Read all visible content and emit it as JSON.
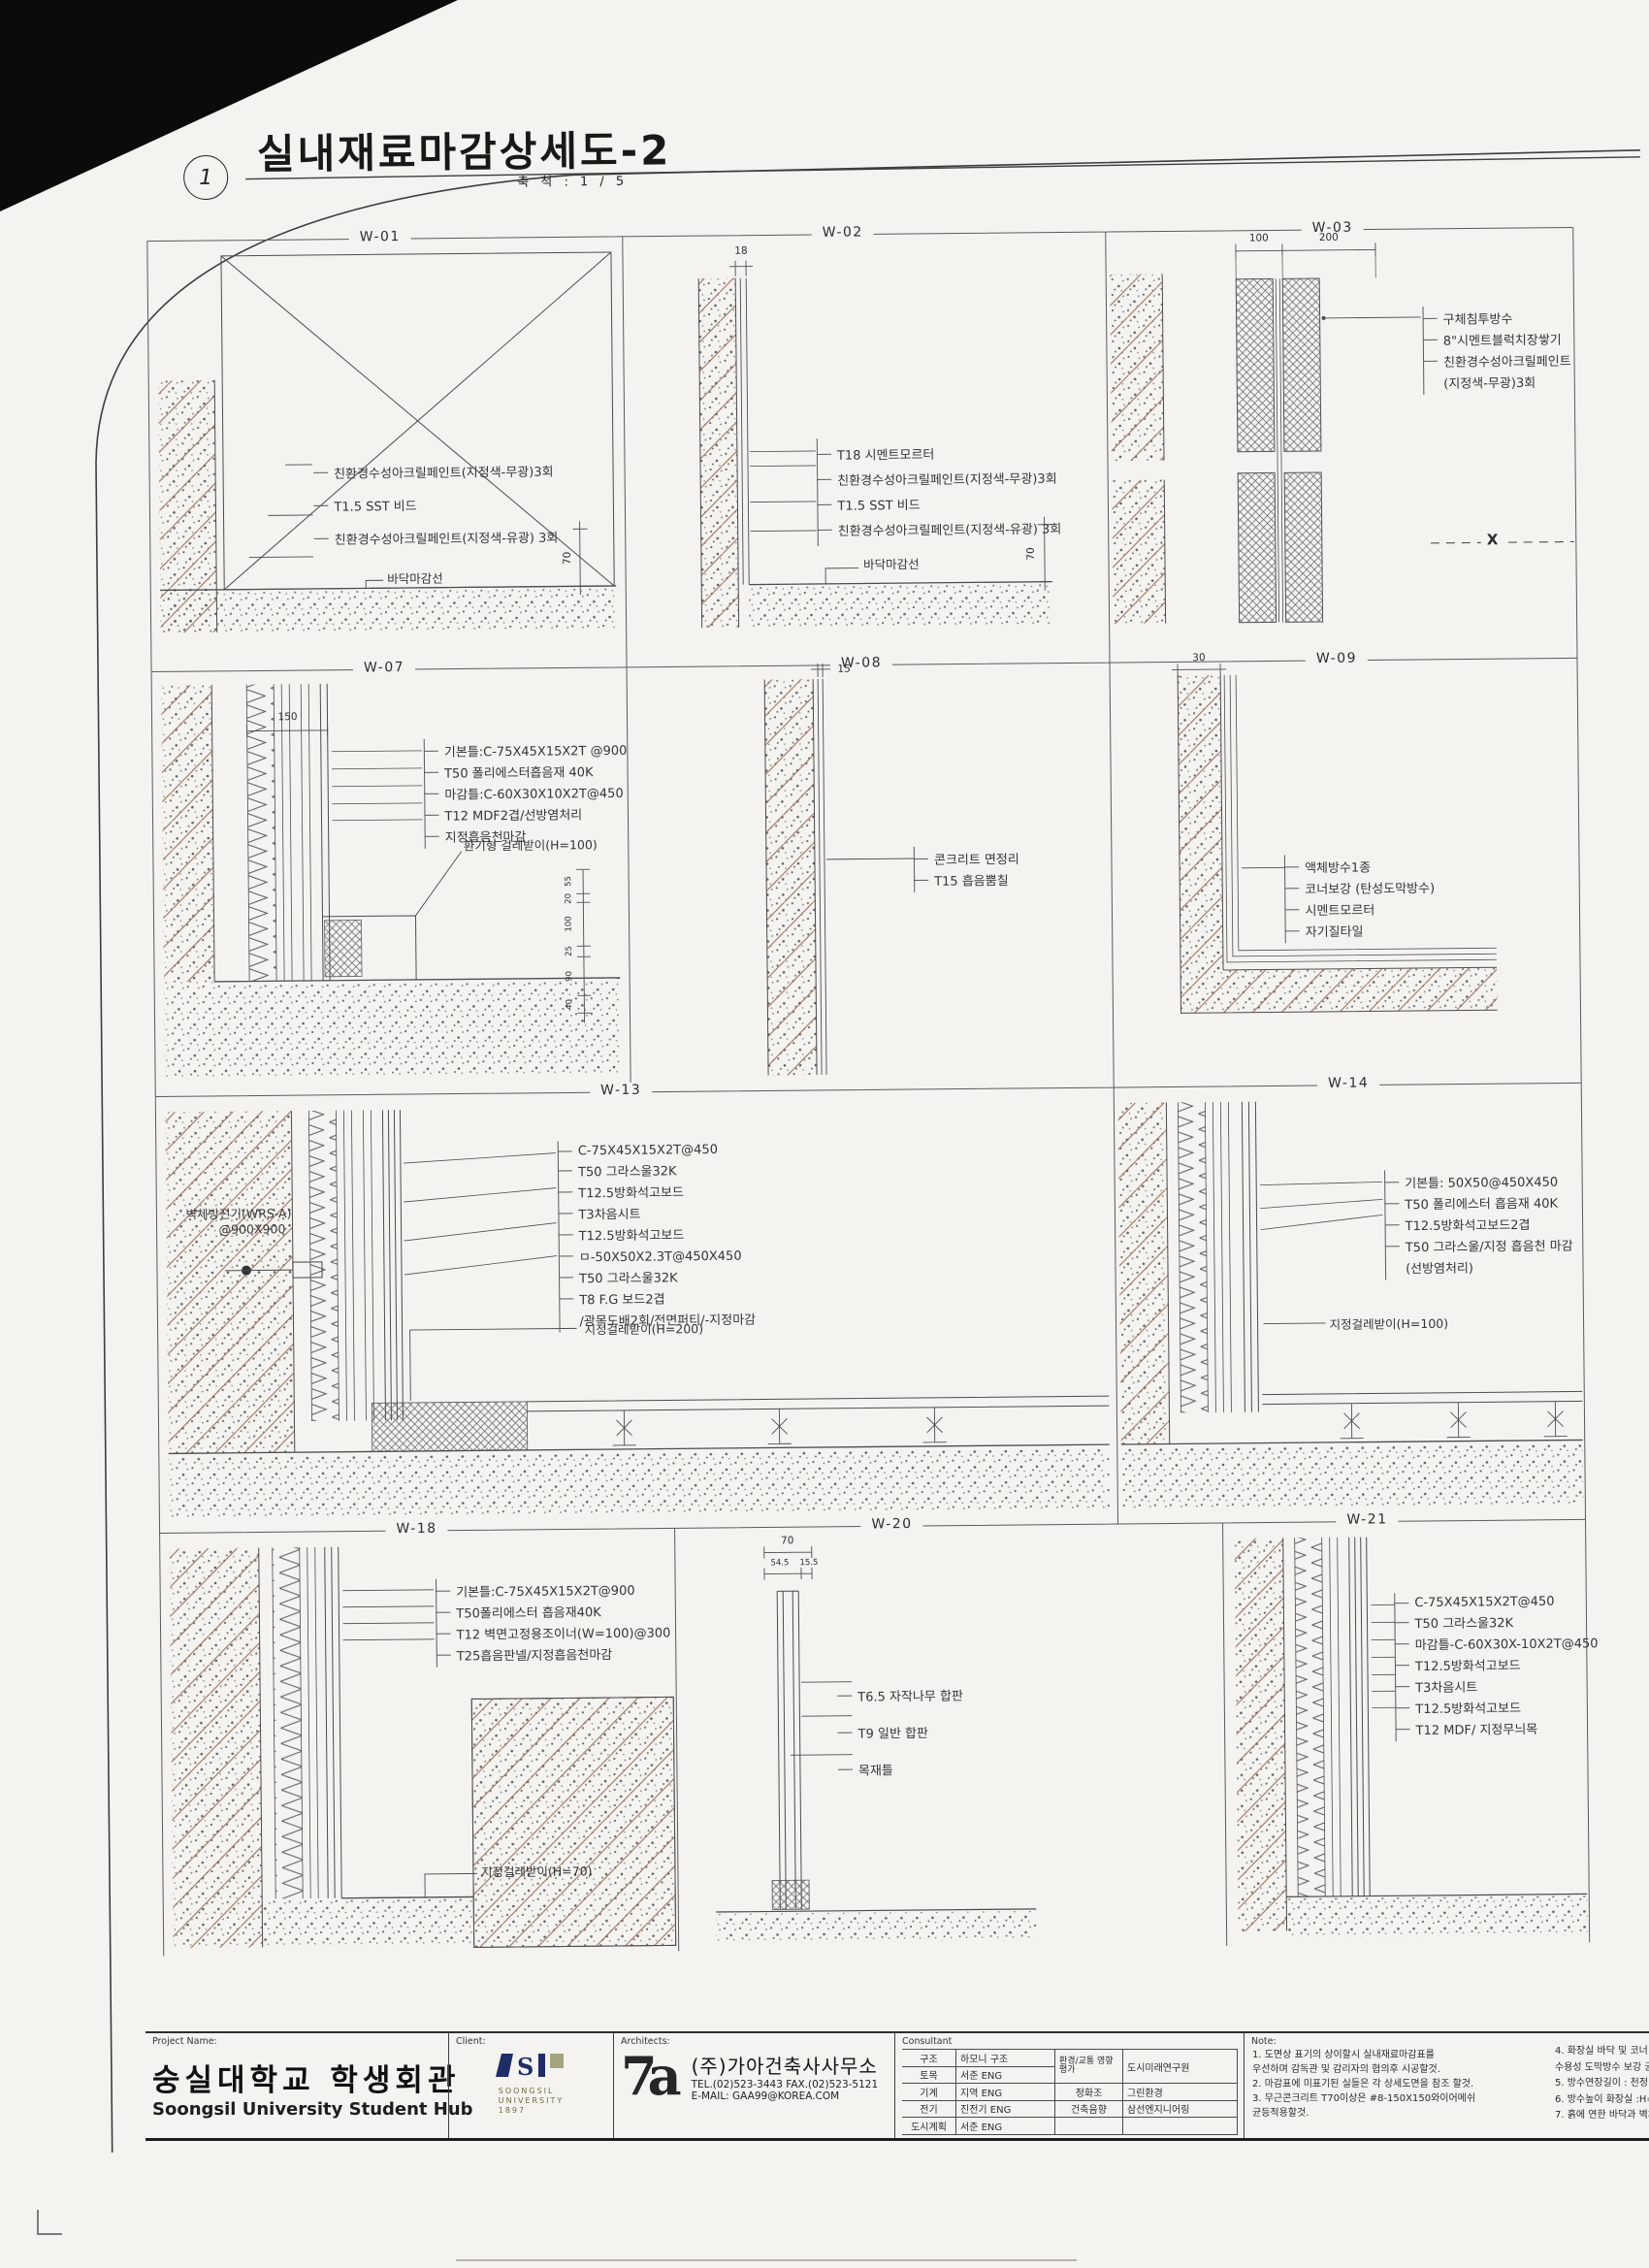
{
  "sheet": {
    "drawing_number": "1",
    "title": "실내재료마감상세도-2",
    "scale_label": "축 척 : 1 / 5"
  },
  "panels": {
    "w01": {
      "label": "W-01",
      "annotations": [
        "친환경수성아크릴페인트(지정색-무광)3회",
        "T1.5 SST 비드",
        "친환경수성아크릴페인트(지정색-유광) 3회"
      ],
      "floor_label": "바닥마감선",
      "dims": {
        "height": "70"
      }
    },
    "w02": {
      "label": "W-02",
      "annotations": [
        "T18 시멘트모르터",
        "친환경수성아크릴페인트(지정색-무광)3회",
        "T1.5 SST 비드",
        "친환경수성아크릴페인트(지정색-유광) 3회"
      ],
      "floor_label": "바닥마감선",
      "dims": {
        "top": "18",
        "height": "70"
      }
    },
    "w03": {
      "label": "W-03",
      "annotations": [
        "구체침투방수",
        "8\"시멘트블럭치장쌓기",
        "친환경수성아크릴페인트",
        "(지정색-무광)3회"
      ],
      "dims": {
        "left": "100",
        "right": "200"
      },
      "x_mark": "X"
    },
    "w07": {
      "label": "W-07",
      "annotations": [
        "기본틀:C-75X45X15X2T @900",
        "T50 폴리에스터흡음재 40K",
        "마감틀:C-60X30X10X2T@450",
        "T12 MDF2겹/선방염처리",
        "지정흡음천마감"
      ],
      "skirting_label": "환기형 걸레받이(H=100)",
      "dims": {
        "top": "150",
        "chain": [
          "55",
          "20",
          "100",
          "25",
          "90",
          "40"
        ]
      }
    },
    "w08": {
      "label": "W-08",
      "annotations": [
        "콘크리트 면정리",
        "T15 흡음뿜칠"
      ],
      "dims": {
        "top": "15"
      }
    },
    "w09": {
      "label": "W-09",
      "annotations": [
        "액체방수1종",
        "코너보강 (탄성도막방수)",
        "시멘트모르터",
        "자기질타일"
      ],
      "dims": {
        "top": "30"
      }
    },
    "w13": {
      "label": "W-13",
      "device_label": "벽체방진기(WRS-A)",
      "device_spec": "@900X900",
      "annotations": [
        "C-75X45X15X2T@450",
        "T50 그라스울32K",
        "T12.5방화석고보드",
        "T3차음시트",
        "T12.5방화석고보드",
        "ㅁ-50X50X2.3T@450X450",
        "T50 그라스울32K",
        "T8 F.G 보드2겹",
        "/광목도배2회/전면퍼티/-지정마감"
      ],
      "skirting_label": "지정걸레받이(H=200)"
    },
    "w14": {
      "label": "W-14",
      "annotations": [
        "기본틀: 50X50@450X450",
        "T50 폴리에스터 흡음재 40K",
        "T12.5방화석고보드2겹",
        "T50 그라스울/지정 흡음천 마감",
        "(선방염처리)"
      ],
      "skirting_label": "지정걸레받이(H=100)"
    },
    "w18": {
      "label": "W-18",
      "annotations": [
        "기본틀:C-75X45X15X2T@900",
        "T50폴리에스터 흡음재40K",
        "T12 벽면고정용조이너(W=100)@300",
        "T25흡음판넬/지정흡음천마감"
      ],
      "skirting_label": "지정걸레받이(H=70)"
    },
    "w20": {
      "label": "W-20",
      "annotations": [
        "T6.5 자작나무 합판",
        "T9 일반 합판",
        "목재틀"
      ],
      "dims": {
        "top": "70",
        "left": "54.5",
        "right": "15.5"
      }
    },
    "w21": {
      "label": "W-21",
      "annotations": [
        "C-75X45X15X2T@450",
        "T50 그라스울32K",
        "마감틀-C-60X30X-10X2T@450",
        "T12.5방화석고보드",
        "T3차음시트",
        "T12.5방화석고보드",
        "T12 MDF/ 지정무늬목"
      ]
    }
  },
  "titleblock": {
    "project": {
      "label": "Project Name:",
      "name_ko": "숭실대학교 학생회관",
      "name_en": "Soongsil University Student Hub"
    },
    "client": {
      "label": "Client:",
      "logo_lines": [
        "SOONGSIL",
        "UNIVERSITY",
        "1897"
      ]
    },
    "architects": {
      "label": "Architects:",
      "firm": "(주)가아건축사사무소",
      "tel": "TEL.(02)523-3443 FAX.(02)523-5121",
      "email": "E-MAIL: GAA99@KOREA.COM"
    },
    "consultant": {
      "label": "Consultant",
      "left_rows": [
        {
          "field": "구조",
          "name": "하모니 구조"
        },
        {
          "field": "토목",
          "name": "서준 ENG"
        },
        {
          "field": "기계",
          "name": "지역 ENG"
        },
        {
          "field": "전기",
          "name": "진전기 ENG"
        },
        {
          "field": "도시계획",
          "name": "서준 ENG"
        }
      ],
      "right_rows": [
        {
          "field": "환경/교통 영향평가",
          "name": "도시미래연구원"
        },
        {
          "field": "정화조",
          "name": "그린환경"
        },
        {
          "field": "건축음향",
          "name": "삼선엔지니어링"
        }
      ]
    },
    "note": {
      "label": "Note:",
      "items_left": [
        "1. 도면상 표기의 상이할시 실내재료마감표를",
        "    우선하며 감독관 및 감리자의 협의후 시공할것.",
        "2. 마감표에 미표기된 실들은 각 상세도면을 참조 할것.",
        "3. 무근콘크리트 T70이상은 #8-150X150와이어메쉬",
        "    균등적용할것."
      ],
      "items_right": [
        "4. 화장실 바닥 및 코너 보강",
        "    수용성 도막방수 보강 균등적",
        "5. 방수연장길이 : 천정 및 벽체",
        "6. 방수높이  화장실 :H=1200",
        "7. 흙에 연한 바닥과 벽체에 구"
      ]
    }
  }
}
